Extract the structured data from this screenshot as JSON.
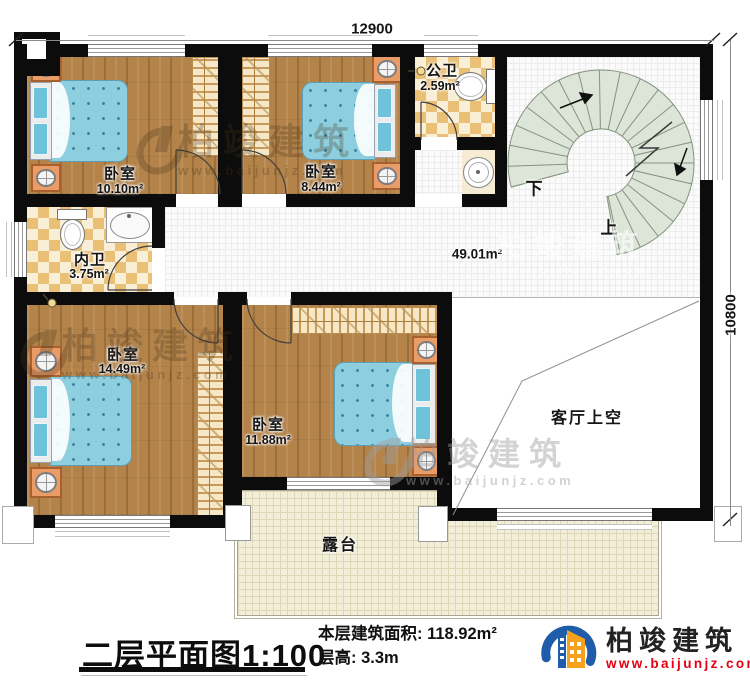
{
  "dimensions": {
    "width_mm": "12900",
    "depth_mm": "10800"
  },
  "rooms": {
    "bedroom_top_left": {
      "name": "卧室",
      "area": "10.10m²"
    },
    "bedroom_top_mid": {
      "name": "卧室",
      "area": "8.44m²"
    },
    "public_bath": {
      "name": "公卫",
      "area": "2.59m²"
    },
    "inner_bath": {
      "name": "内卫",
      "area": "3.75m²"
    },
    "hall": {
      "area": "49.01m²"
    },
    "bedroom_bottom_left": {
      "name": "卧室",
      "area": "14.49m²"
    },
    "bedroom_bottom_mid": {
      "name": "卧室",
      "area": "11.88m²"
    },
    "living_room_void": {
      "name": "客厅上空"
    },
    "terrace": {
      "name": "露台"
    }
  },
  "stairs": {
    "down": "下",
    "up": "上"
  },
  "watermark": {
    "brand": "柏竣建筑",
    "url": "www.baijunjz.com"
  },
  "title_block": {
    "plan_title": "二层平面图",
    "scale": "1:100",
    "floor_area_label": "本层建筑面积:",
    "floor_area_value": "118.92m²",
    "floor_height_label": "层高:",
    "floor_height_value": "3.3m"
  },
  "logo": {
    "brand": "柏竣建筑",
    "url": "www.baijunjz.com"
  },
  "brand_colors": {
    "logo_blue": "#1f5ca9",
    "logo_orange": "#f6a21d",
    "logo_red": "#e60012"
  }
}
